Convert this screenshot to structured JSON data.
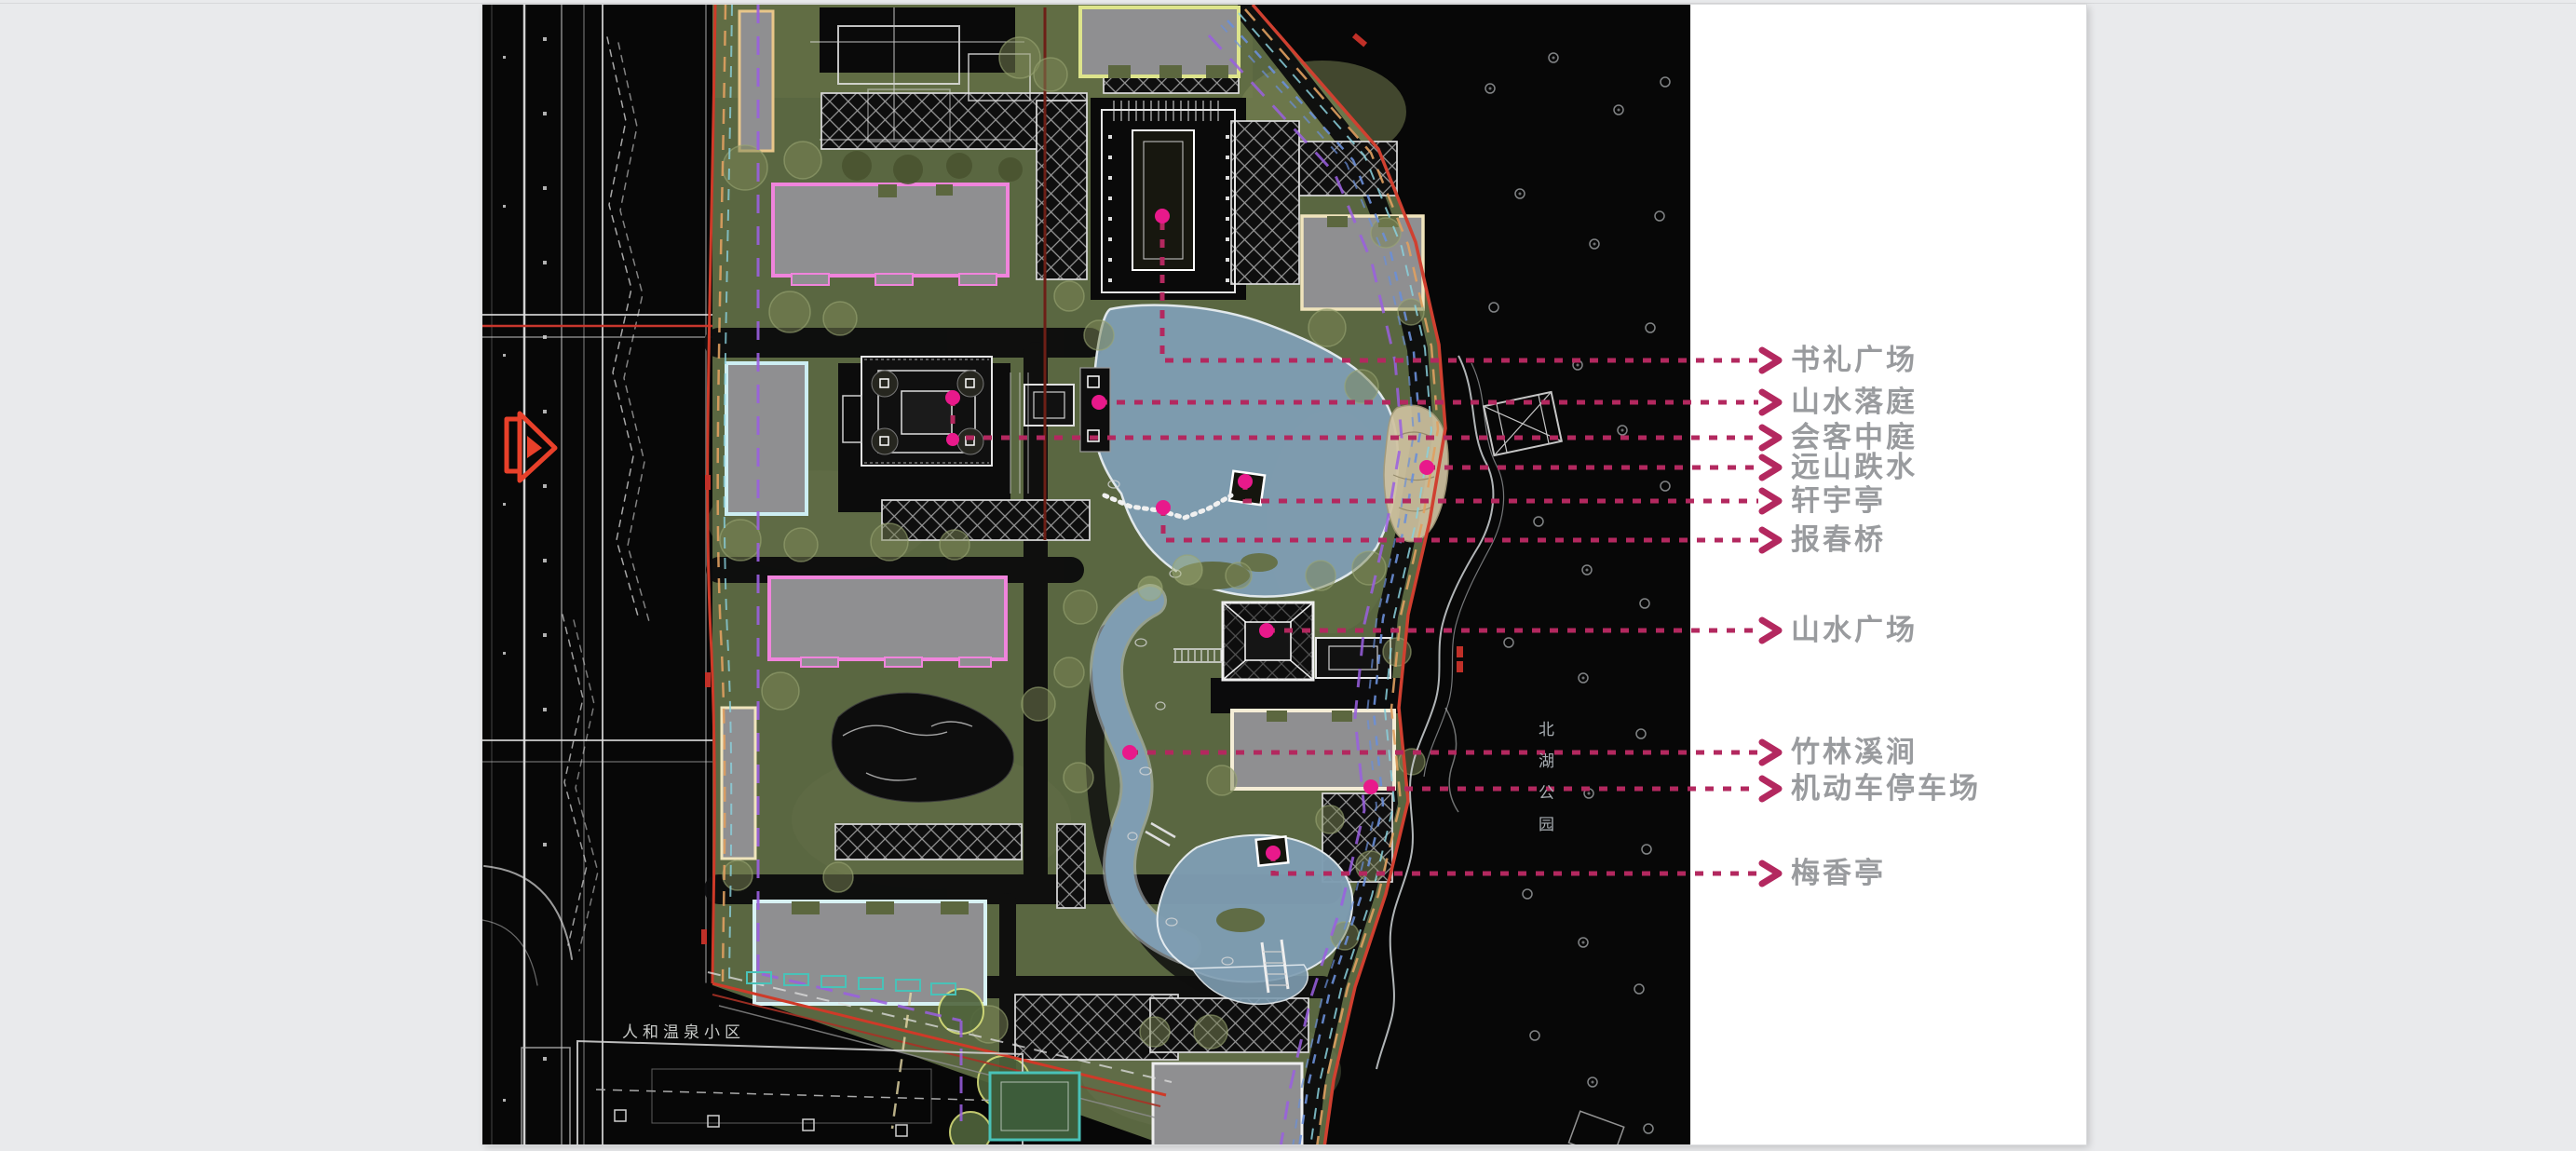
{
  "page": {
    "background_color": "#e9eaec"
  },
  "slide": {
    "background_color": "#ffffff",
    "description": "landscape masterplan site plan with callouts"
  },
  "plan": {
    "region_labels": {
      "neighbor_area": "人和温泉小区",
      "adjacent_park": "北湖公园"
    },
    "colors": {
      "site_green": "#5a6741",
      "water_blue": "#7f9db2",
      "building_gray": "#8f8f91",
      "boundary_red": "#cf3a28",
      "outline_magenta": "#f084dc",
      "outline_cream": "#f0e4bc",
      "outline_cyan": "#cdeef2",
      "leader_magenta": "#b3285f",
      "anchor_pink": "#e8198b",
      "label_text_gray": "#999b9e"
    }
  },
  "annotations": {
    "labels": [
      {
        "id": "shuli-plaza",
        "text": "书礼广场"
      },
      {
        "id": "shanshui-court",
        "text": "山水落庭"
      },
      {
        "id": "guest-atrium",
        "text": "会客中庭"
      },
      {
        "id": "mountain-cascade",
        "text": "远山跌水"
      },
      {
        "id": "xuanyu-pavilion",
        "text": "轩宇亭"
      },
      {
        "id": "baochun-bridge",
        "text": "报春桥"
      },
      {
        "id": "shanshui-plaza",
        "text": "山水广场"
      },
      {
        "id": "bamboo-stream",
        "text": "竹林溪涧"
      },
      {
        "id": "parking-lot",
        "text": "机动车停车场"
      },
      {
        "id": "meixiang-pavilion",
        "text": "梅香亭"
      }
    ]
  }
}
